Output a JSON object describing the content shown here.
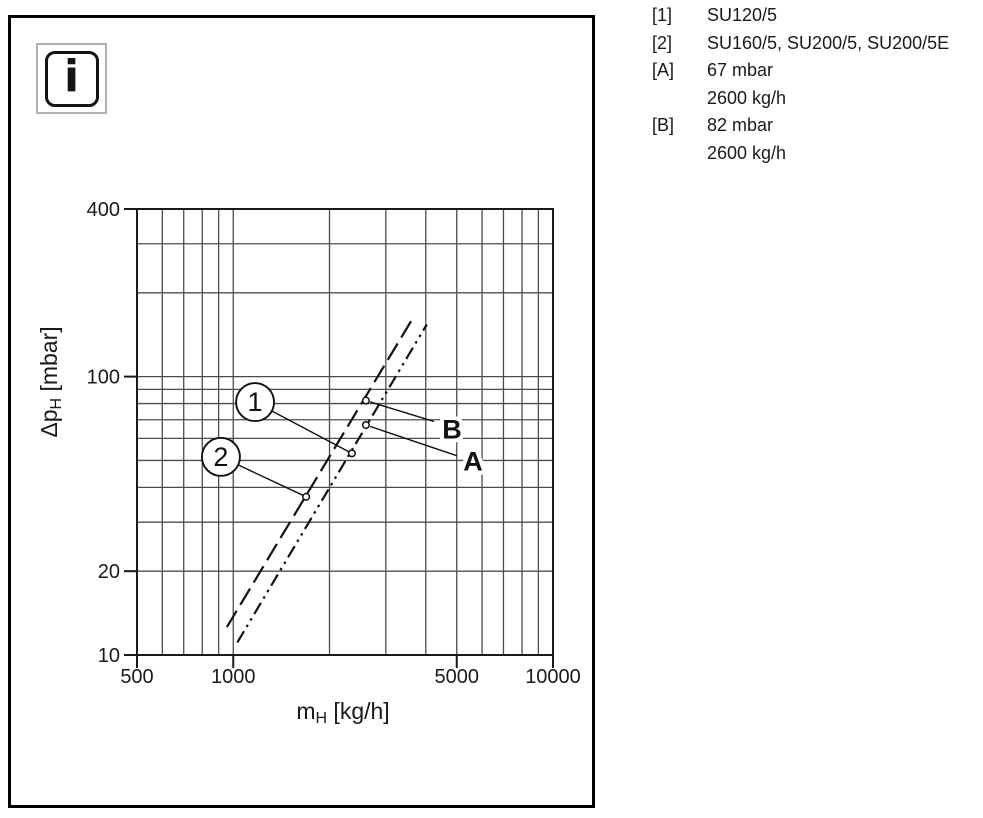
{
  "colors": {
    "ink": "#1a1a1a",
    "grid": "#4d4d4d",
    "background": "#ffffff",
    "frame": "#000000"
  },
  "info_icon": {
    "glyph": "i"
  },
  "legend": {
    "rows": [
      {
        "key": "[1]",
        "value": "SU120/5"
      },
      {
        "key": "[2]",
        "value": "SU160/5, SU200/5, SU200/5E"
      },
      {
        "key": "[A]",
        "value": "67 mbar"
      },
      {
        "key": "",
        "value": "2600 kg/h"
      },
      {
        "key": "[B]",
        "value": "82 mbar"
      },
      {
        "key": "",
        "value": "2600 kg/h"
      }
    ]
  },
  "chart_data": {
    "type": "line",
    "title": "",
    "x_axis": {
      "label_pre": "m",
      "label_sub": "H",
      "label_post": " [kg/h]",
      "scale": "log",
      "min": 500,
      "max": 10000,
      "labeled_ticks": [
        500,
        1000,
        5000,
        10000
      ],
      "gridlines": [
        600,
        700,
        800,
        900,
        1000,
        2000,
        3000,
        4000,
        5000,
        6000,
        7000,
        8000,
        9000
      ]
    },
    "y_axis": {
      "label_pre": "Δp",
      "label_sub": "H",
      "label_post": " [mbar]",
      "scale": "log",
      "min": 10,
      "max": 400,
      "labeled_ticks": [
        400,
        100,
        20,
        10
      ],
      "gridlines": [
        300,
        200,
        100,
        90,
        80,
        70,
        60,
        50,
        40,
        30,
        20
      ]
    },
    "grid": "on",
    "legend_position": "outside-right",
    "series": [
      {
        "id": "1",
        "name": "SU120/5",
        "line_style": "dash-dot-dot",
        "points": [
          [
            1030,
            11.1
          ],
          [
            4030,
            154
          ]
        ]
      },
      {
        "id": "2",
        "name": "SU160/5, SU200/5, SU200/5E",
        "line_style": "long-dash",
        "points": [
          [
            955,
            12.6
          ],
          [
            3620,
            160
          ]
        ]
      }
    ],
    "point_markers": [
      {
        "id": "A",
        "x": 2600,
        "y": 67
      },
      {
        "id": "B",
        "x": 2600,
        "y": 82
      }
    ],
    "callouts": [
      {
        "text": "1",
        "at": [
          1170,
          81
        ],
        "target": [
          2350,
          53
        ]
      },
      {
        "text": "2",
        "at": [
          915,
          51.5
        ],
        "target": [
          1690,
          37
        ]
      }
    ],
    "point_labels": [
      {
        "text": "B",
        "point": [
          2600,
          82
        ],
        "leader_end": [
          4240,
          69
        ],
        "text_at": [
          4830,
          64.5
        ]
      },
      {
        "text": "A",
        "point": [
          2600,
          67
        ],
        "leader_end": [
          5000,
          52
        ],
        "text_at": [
          5620,
          49.5
        ]
      }
    ]
  }
}
